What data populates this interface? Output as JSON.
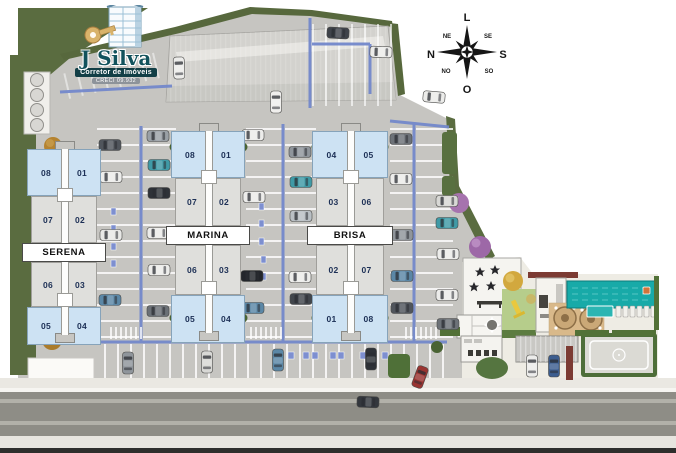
{
  "logo": {
    "name": "J Silva",
    "tagline": "Corretor de Imóveis",
    "registration": "CRECI 09.932"
  },
  "compass": {
    "top": "L",
    "right": "S",
    "bottom": "O",
    "left": "N",
    "top_left": "NE",
    "top_right": "SE",
    "bottom_left": "NO",
    "bottom_right": "SO"
  },
  "buildings": [
    {
      "name": "SERENA",
      "sections": [
        {
          "left": "08",
          "right": "01"
        },
        {
          "left": "07",
          "right": "02"
        },
        {
          "left": "06",
          "right": "03"
        },
        {
          "left": "05",
          "right": "04"
        }
      ]
    },
    {
      "name": "MARINA",
      "sections": [
        {
          "left": "08",
          "right": "01"
        },
        {
          "left": "07",
          "right": "02"
        },
        {
          "left": "06",
          "right": "03"
        },
        {
          "left": "05",
          "right": "04"
        }
      ]
    },
    {
      "name": "BRISA",
      "sections": [
        {
          "left": "04",
          "right": "05"
        },
        {
          "left": "03",
          "right": "06"
        },
        {
          "left": "02",
          "right": "07"
        },
        {
          "left": "01",
          "right": "08"
        }
      ]
    }
  ],
  "colors": {
    "lane_blue": "#7388cb",
    "building_blue": "#cde2f3",
    "pool_teal": "#18aaa8",
    "landscape_green": "#5a6c40",
    "brand_teal": "#11525c",
    "pavement_gray": "#c6c5c1"
  }
}
